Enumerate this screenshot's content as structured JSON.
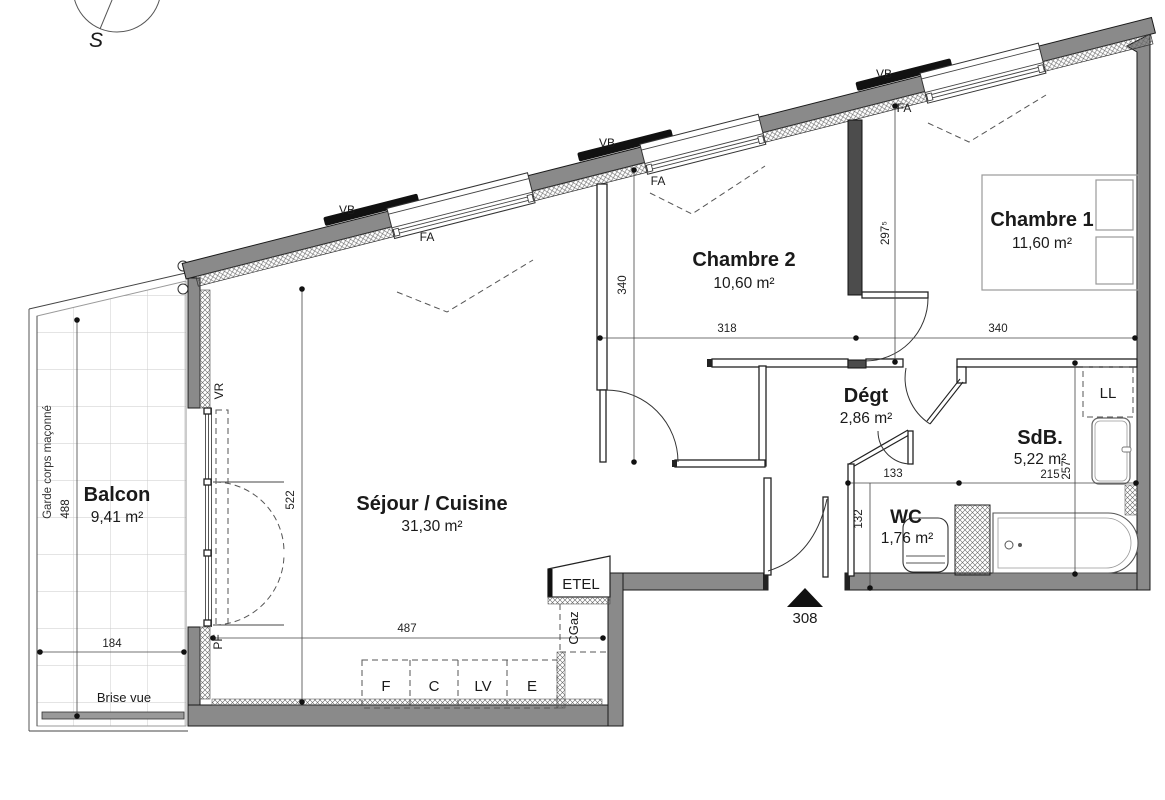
{
  "compass": {
    "south": "S"
  },
  "entrance": {
    "number": "308"
  },
  "rooms": [
    {
      "id": "balcon",
      "name": "Balcon",
      "area": "9,41 m²"
    },
    {
      "id": "sejour-cuisine",
      "name": "Séjour / Cuisine",
      "area": "31,30 m²"
    },
    {
      "id": "chambre-2",
      "name": "Chambre 2",
      "area": "10,60 m²"
    },
    {
      "id": "chambre-1",
      "name": "Chambre 1",
      "area": "11,60 m²"
    },
    {
      "id": "degagement",
      "name": "Dégt",
      "area": "2,86 m²"
    },
    {
      "id": "salle-de-bain",
      "name": "SdB.",
      "area": "5,22 m²"
    },
    {
      "id": "wc",
      "name": "WC",
      "area": "1,76 m²"
    }
  ],
  "dims": {
    "balcon_h": {
      "value": "488"
    },
    "balcon_w": {
      "value": "184"
    },
    "sejour_h": {
      "value": "522"
    },
    "sejour_w": {
      "value": "487"
    },
    "ch2_h": {
      "value": "340"
    },
    "ch2_w": {
      "value": "318"
    },
    "ch1_h": {
      "value": "297⁵"
    },
    "ch1_w": {
      "value": "340"
    },
    "degt_w": {
      "value": "133"
    },
    "sdb_w": {
      "value": "215"
    },
    "sdb_h": {
      "value": "257"
    },
    "wc_h": {
      "value": "132"
    }
  },
  "openings": {
    "vb": "VB",
    "fa": "FA",
    "vr": "VR",
    "pf": "PF"
  },
  "fixtures": {
    "etel": "ETEL",
    "cgaz": "CGaz",
    "ll": "LL"
  },
  "kitchen": {
    "items": [
      {
        "label": "F"
      },
      {
        "label": "C"
      },
      {
        "label": "LV"
      },
      {
        "label": "E"
      }
    ]
  },
  "site": {
    "garde_corps": "Garde corps maçonné",
    "brise_vue": "Brise vue"
  },
  "colors": {
    "wall": "#8a8a8a",
    "wall_dark": "#4c4c4c",
    "line": "#1a1a1a"
  }
}
